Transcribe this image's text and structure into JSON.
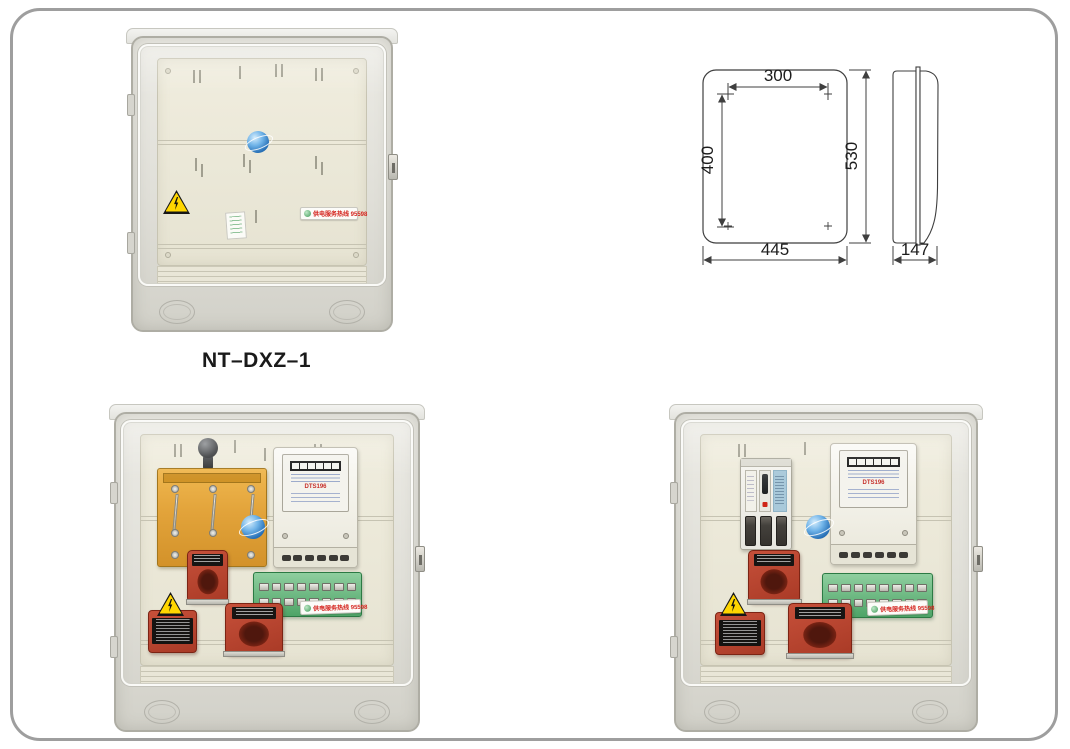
{
  "page": {
    "background_color": "#ffffff",
    "frame_color": "#9e9e9e"
  },
  "product": {
    "model_label": "NT–DXZ–1"
  },
  "dimension_drawing": {
    "front_view": {
      "hole_spacing_width": "300",
      "hole_spacing_height": "400",
      "overall_height": "530",
      "overall_width": "445"
    },
    "side_view": {
      "overall_depth": "147"
    }
  },
  "labels": {
    "hotline_sticker": "供电服务热线  95598",
    "warning_icon": "lightning-bolt",
    "brand_watermark_icon": "blue-globe"
  },
  "meter": {
    "model_line": "DTS196"
  }
}
